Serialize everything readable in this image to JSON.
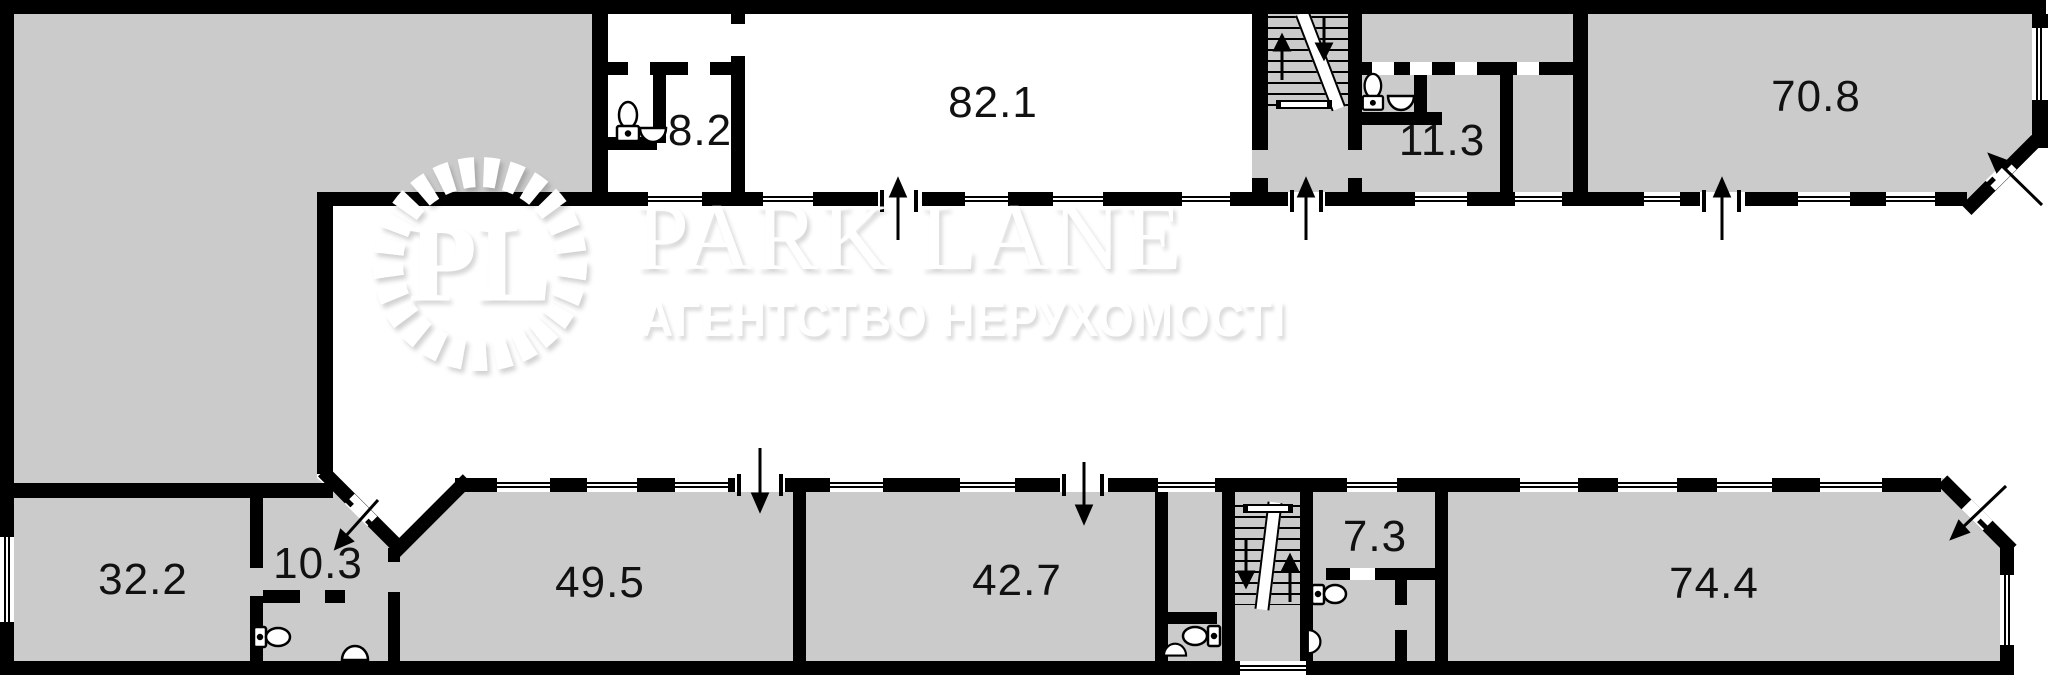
{
  "plan": {
    "type": "floor-plan",
    "width_px": 2048,
    "height_px": 675
  },
  "watermark": {
    "monogram": "PL",
    "brand": "PARK LANE",
    "tagline": "АГЕНТСТВО НЕРУХОМОСТІ"
  },
  "colors": {
    "wall": "#000000",
    "room_fill": "#cbcbcb",
    "background": "#ffffff",
    "watermark_text": "#ffffff",
    "label_text": "#111111"
  },
  "rooms": [
    {
      "id": "room-8-2",
      "area": "8.2"
    },
    {
      "id": "room-82-1",
      "area": "82.1"
    },
    {
      "id": "room-11-3",
      "area": "11.3"
    },
    {
      "id": "room-70-8",
      "area": "70.8"
    },
    {
      "id": "room-32-2",
      "area": "32.2"
    },
    {
      "id": "room-10-3",
      "area": "10.3"
    },
    {
      "id": "room-49-5",
      "area": "49.5"
    },
    {
      "id": "room-42-7",
      "area": "42.7"
    },
    {
      "id": "room-7-3",
      "area": "7.3"
    },
    {
      "id": "room-74-4",
      "area": "74.4"
    }
  ],
  "icons": [
    "toilet-icon",
    "sink-icon",
    "staircase-icon",
    "entrance-arrow-icon",
    "stair-direction-arrow-icon",
    "window-symbol",
    "door-opening-symbol",
    "laurel-wreath-icon"
  ]
}
